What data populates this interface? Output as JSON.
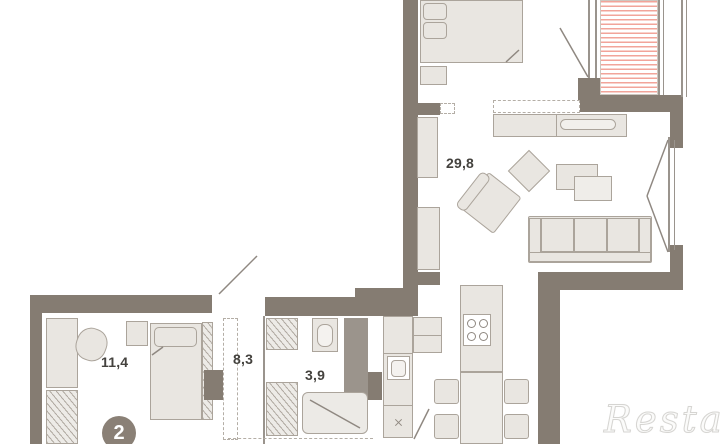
{
  "plan": {
    "type": "apartment-floor-plan",
    "labels": {
      "living_area": "29,8",
      "bedroom_area": "11,4",
      "hall_area": "8,3",
      "bathroom_area": "3,9"
    },
    "badge_number": "2",
    "watermark": "Restate",
    "colors": {
      "wall": "#857c72",
      "wall2": "#9b948c",
      "furniture_fill": "#e9e6e1",
      "furniture_border": "#aba49b",
      "balcony_hatch": "#f2a49a",
      "dash": "#b4aea6",
      "line": "#9a948d",
      "label_text": "#44423e",
      "badge_bg": "#8a8076",
      "watermark_color": "#d6d5d2"
    }
  }
}
